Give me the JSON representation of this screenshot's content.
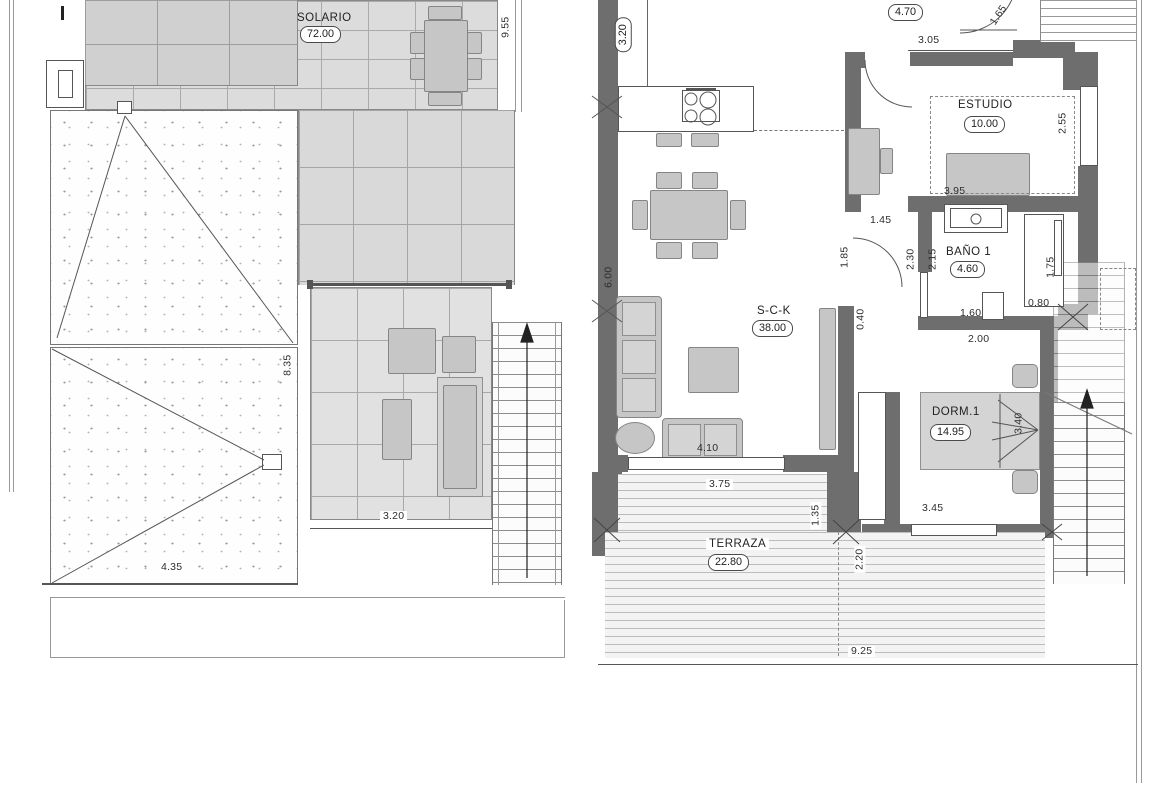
{
  "drawing_type": "floor-plan",
  "colors": {
    "wall": "#6e6e6e",
    "tile": "#dcdcdc",
    "furniture": "#c6c6c6",
    "linework": "#555555"
  },
  "left_plan": {
    "name": "solarium-roof-level",
    "rooms": [
      {
        "name": "SOLARIO",
        "area": "72.00"
      }
    ],
    "dimensions": {
      "d955": "9.55",
      "d835": "8.35",
      "d435": "4.35",
      "d320": "3.20"
    }
  },
  "right_plan": {
    "name": "main-floor-level",
    "rooms": [
      {
        "name": "S-C-K",
        "area": "38.00"
      },
      {
        "name": "ESTUDIO",
        "area": "10.00"
      },
      {
        "name": "BAÑO 1",
        "area": "4.60"
      },
      {
        "name": "DORM.1",
        "area": "14.95"
      },
      {
        "name": "TERRAZA",
        "area": "22.80"
      }
    ],
    "dimensions": {
      "d320v": "3.20",
      "d470": "4.70",
      "d165": "1.65",
      "d305": "3.05",
      "d255": "2.55",
      "d395": "3.95",
      "d145": "1.45",
      "d185": "1.85",
      "d230": "2.30",
      "d215": "2.15",
      "d175": "1.75",
      "d080": "0.80",
      "d160": "1.60",
      "d200": "2.00",
      "d600": "6.00",
      "d040": "0.40",
      "d410": "4.10",
      "d375": "3.75",
      "d135": "1.35",
      "d345": "3.45",
      "d340": "3.40",
      "d220": "2.20",
      "d925": "9.25"
    }
  }
}
